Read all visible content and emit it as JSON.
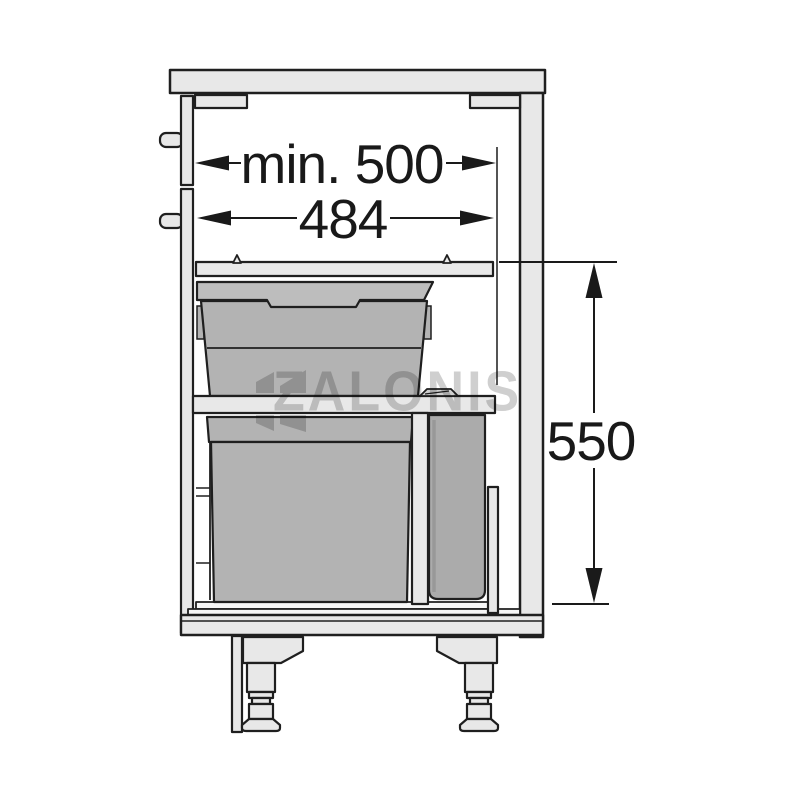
{
  "diagram": {
    "kind": "technical line drawing",
    "subject": "kitchen base cabinet cross-section with two-tier pull-out waste bin unit and adjustable feet",
    "annotations": {
      "min_width": {
        "label": "min. 500",
        "value": 500,
        "qualifier": "min."
      },
      "unit_width": {
        "label": "484",
        "value": 484
      },
      "unit_height": {
        "label": "550",
        "value": 550
      }
    },
    "watermark": {
      "text": "ZALONIS"
    },
    "colors": {
      "background": "#ffffff",
      "outline": "#1f1f1f",
      "panel_fill": "#e8e8e8",
      "bin_fill": "#b3b3b3",
      "lid_fill": "#bdbdbd",
      "small_bin_fill": "#ababab",
      "dimension_ink": "#1a1a1a",
      "watermark_gray": "#8c8c8c"
    }
  }
}
